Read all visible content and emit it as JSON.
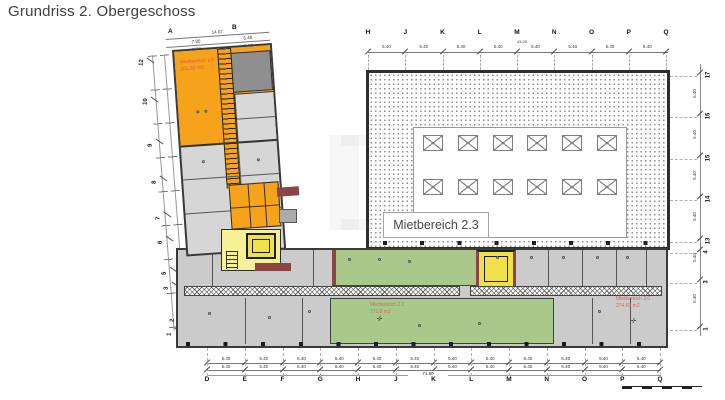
{
  "title": "Grundriss 2. Obergeschoss",
  "colors": {
    "accent_orange": "#F6A21B",
    "pale_yellow": "#F6F096",
    "stair_yellow": "#EFE14B",
    "green": "#A9C98B",
    "room_gray": "#CBCBCB",
    "dark_room_gray": "#8F8F8F",
    "wall_dark": "#3A3A3A",
    "wall_red": "#8C4444",
    "area_label_red": "#D9635B"
  },
  "areas": {
    "area1": {
      "name": "Mietbereich 1.0",
      "size": "201.83 m2"
    },
    "area22": {
      "name": "Mietbereich 2.2",
      "size": "771.8 m2"
    },
    "area23": {
      "name": "Mietbereich 2.3"
    },
    "area30": {
      "name": "Mietbereich 3.0",
      "size": "274.69 m2"
    }
  },
  "axes": {
    "top": {
      "letters": [
        "H",
        "J",
        "K",
        "L",
        "M",
        "N",
        "O",
        "P",
        "Q"
      ],
      "segments": [
        "5.40",
        "5.40",
        "5.40",
        "5.40",
        "5.40",
        "5.40",
        "5.40",
        "5.40"
      ],
      "total": "43.20"
    },
    "bottom": {
      "letters": [
        "D",
        "E",
        "F",
        "G",
        "H",
        "J",
        "K",
        "L",
        "M",
        "N",
        "O",
        "P",
        "Q"
      ],
      "segments": [
        "5.40",
        "5.40",
        "5.40",
        "5.40",
        "5.40",
        "5.40",
        "5.40",
        "5.40",
        "5.40",
        "5.40",
        "5.40",
        "5.40"
      ],
      "total": "71.80"
    },
    "right": {
      "numbers": [
        {
          "label": "17",
          "y": 76
        },
        {
          "label": "16",
          "y": 117
        },
        {
          "label": "15",
          "y": 159
        },
        {
          "label": "14",
          "y": 200
        },
        {
          "label": "13",
          "y": 242
        },
        {
          "label": "4",
          "y": 253
        },
        {
          "label": "3",
          "y": 283
        },
        {
          "label": "1",
          "y": 330
        }
      ],
      "segments": [
        "5.40",
        "5.40",
        "5.40",
        "5.40",
        "5.40",
        "5.40"
      ]
    },
    "left": {
      "numbers": [
        {
          "label": "12",
          "x": 137,
          "y": 58
        },
        {
          "label": "10",
          "x": 141,
          "y": 97
        },
        {
          "label": "9",
          "x": 146,
          "y": 139
        },
        {
          "label": "8",
          "x": 150,
          "y": 176
        },
        {
          "label": "7",
          "x": 154,
          "y": 212
        },
        {
          "label": "6",
          "x": 156,
          "y": 236
        },
        {
          "label": "5",
          "x": 160,
          "y": 267
        },
        {
          "label": "3",
          "x": 162,
          "y": 282
        },
        {
          "label": "2",
          "x": 168,
          "y": 314
        },
        {
          "label": "1",
          "x": 165,
          "y": 328
        }
      ]
    },
    "wing": {
      "letters": [
        "A",
        "B"
      ],
      "total": "14.07",
      "segments": [
        "7.90",
        "5.40"
      ],
      "segments2": [
        "7.57",
        "5.07"
      ]
    }
  }
}
